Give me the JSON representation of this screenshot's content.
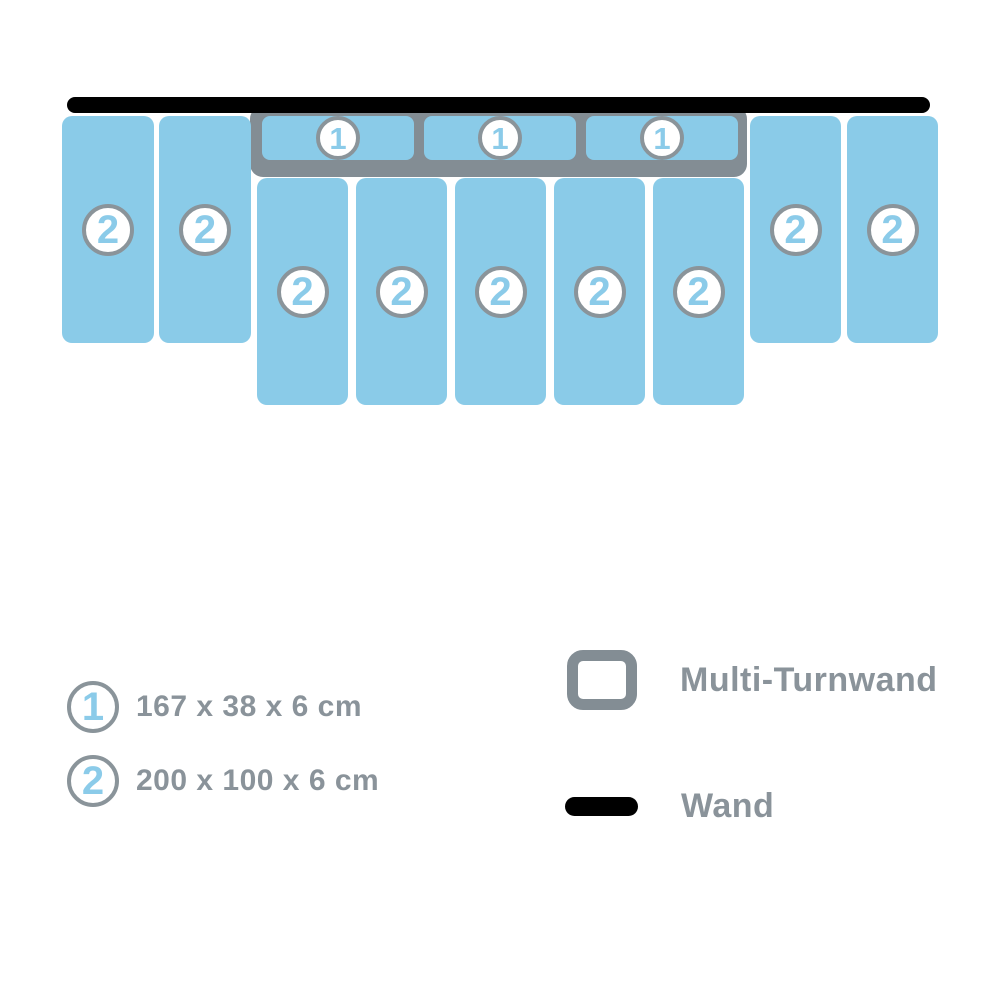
{
  "diagram": {
    "wall_color": "#000000",
    "mat_color": "#8ACBE8",
    "frame_color": "#838D94",
    "badge": {
      "bg": "#FFFFFF",
      "border": "#8A949A",
      "text_color": "#8BCBE9"
    },
    "groups": {
      "left": {
        "badge": "2",
        "count": 2
      },
      "top": {
        "badge": "1",
        "count": 3
      },
      "middle": {
        "badge": "2",
        "count": 5
      },
      "right": {
        "badge": "2",
        "count": 2
      }
    }
  },
  "legend": {
    "text_color": "#8A939A",
    "sizes": [
      {
        "badge": "1",
        "label": "167 x 38 x 6 cm"
      },
      {
        "badge": "2",
        "label": "200 x 100 x 6 cm"
      }
    ],
    "symbols": [
      {
        "icon": "multi-turnwand-outline-icon",
        "label": "Multi-Turnwand"
      },
      {
        "icon": "wand-bar-icon",
        "label": "Wand"
      }
    ]
  }
}
